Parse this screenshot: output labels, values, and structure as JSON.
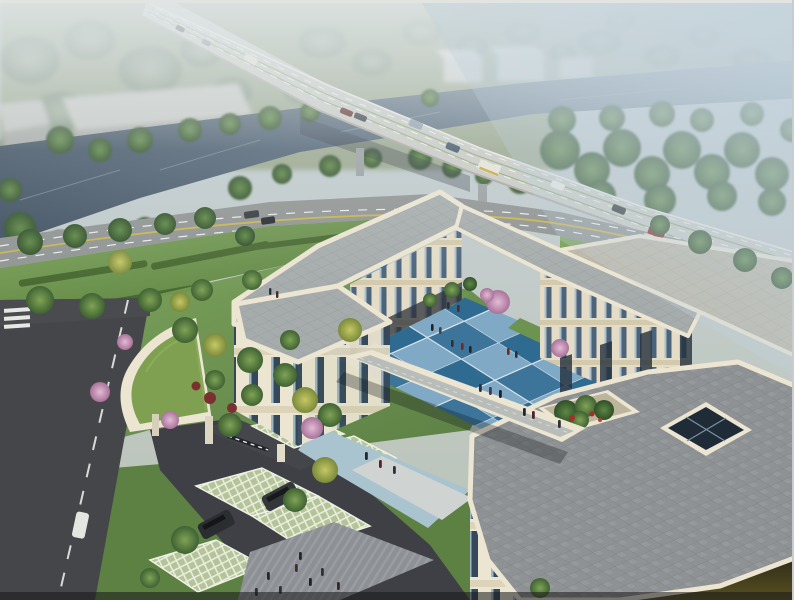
{
  "scene": {
    "type": "architectural-aerial-rendering",
    "subject": "three-storey cream building complex with blue checkered courtyard",
    "setting": [
      "river",
      "elevated-highway-bridge",
      "tree-lined-street",
      "lawns",
      "parking",
      "entrance-gate"
    ],
    "building": {
      "storeys": 3,
      "wings": [
        "west-wing",
        "north-wing",
        "east-wing"
      ],
      "features": [
        "covered-walkway",
        "roof-garden",
        "skylight-atrium",
        "green-roof-gate-canopy",
        "blue-checker-courtyard"
      ]
    },
    "vehicles": {
      "highway_cars": 7,
      "buses": 2,
      "street_cars": 4,
      "parked_suvs": 2,
      "side_street_cars": 1
    },
    "people": {
      "courtyard": 15,
      "south_plaza": 8,
      "forecourt": 3,
      "lawn": 2
    }
  },
  "palette": {
    "sky_top": "#b9c5ce",
    "haze": "#d3dde2",
    "far_field": "#97a38c",
    "far_tree": "#7e8f79",
    "water_dark": "#3c4d5e",
    "water_light": "#5d7285",
    "bridge_deck": "#c9cbc5",
    "bridge_shadow": "#6b7378",
    "road_street": "#8f9392",
    "asphalt_dark": "#3e4045",
    "lane_white": "#e8eae8",
    "lane_yellow": "#c9b44c",
    "lawn_light": "#7aa258",
    "lawn_dark": "#55793c",
    "hedge_green": "#47682f",
    "tree_green": "#4f7a3c",
    "tree_yellow": "#b5bb4f",
    "blossom_pink": "#cf9dc0",
    "wall_cream": "#ece5d2",
    "wall_shade": "#d6cbb0",
    "window_dark": "#35485a",
    "window_lite": "#9db6c6",
    "roof_gray": "#a6abab",
    "roof_big": "#8e9294",
    "roof_tan": "#bcb6a5",
    "court_blue_dark": "#2f6a90",
    "court_blue_light": "#7fa9c4",
    "plaza_gray": "#8d9094",
    "paver_green": "#b5c39a",
    "green_roof": "#7fa050",
    "car_red": "#8e2320",
    "car_dark": "#2b2e30",
    "bus_white": "#e8e6da",
    "people_dark": "#2c3138",
    "frame_white": "#ffffff"
  }
}
